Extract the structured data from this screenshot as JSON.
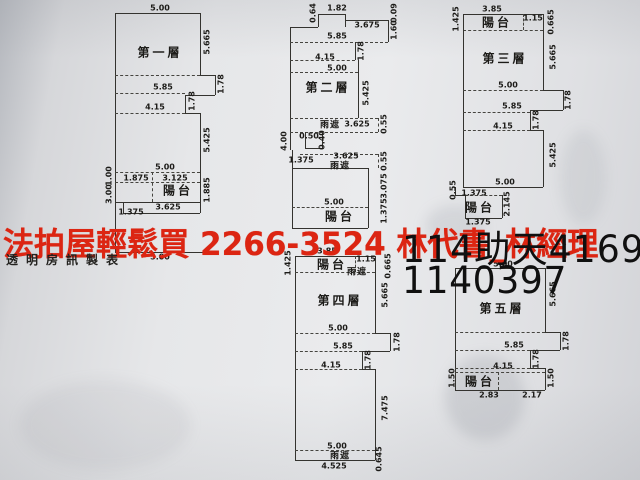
{
  "colors": {
    "red": "#dc2512",
    "ink": "#34332f",
    "paper": "#e7e8ea"
  },
  "overlay": {
    "red_text": "法拍屋輕鬆買  2266-3524  林代書_林經理",
    "maker_text": "透明房訊製表",
    "case_line1": "114助天4169",
    "case_line2": "1140397"
  },
  "floorplans": [
    {
      "id": "floor-1",
      "title": {
        "t": "第一層",
        "x": 160,
        "y": 52
      },
      "labels": [
        {
          "t": "5.00",
          "x": 160,
          "y": 8
        },
        {
          "t": "5.665",
          "x": 207,
          "y": 42,
          "r": 1
        },
        {
          "t": "1.78",
          "x": 221,
          "y": 84,
          "r": 1
        },
        {
          "t": "5.85",
          "x": 163,
          "y": 87
        },
        {
          "t": "1.78",
          "x": 192,
          "y": 101,
          "r": 1
        },
        {
          "t": "4.15",
          "x": 155,
          "y": 107
        },
        {
          "t": "5.425",
          "x": 207,
          "y": 140,
          "r": 1
        },
        {
          "t": "5.00",
          "x": 165,
          "y": 167
        },
        {
          "t": "1.00",
          "x": 109,
          "y": 176,
          "r": 1
        },
        {
          "t": "1.875",
          "x": 136,
          "y": 178
        },
        {
          "t": "3.125",
          "x": 175,
          "y": 178
        },
        {
          "t": "陽台",
          "x": 178,
          "y": 190,
          "k": "room"
        },
        {
          "t": "3.00",
          "x": 109,
          "y": 194,
          "r": 1
        },
        {
          "t": "1.885",
          "x": 207,
          "y": 190,
          "r": 1
        },
        {
          "t": "3.625",
          "x": 168,
          "y": 207
        },
        {
          "t": "1.375",
          "x": 131,
          "y": 212
        },
        {
          "t": "5.00",
          "x": 160,
          "y": 257
        }
      ]
    },
    {
      "id": "floor-2",
      "title": {
        "t": "第二層",
        "x": 328,
        "y": 87
      },
      "labels": [
        {
          "t": "0.64",
          "x": 313,
          "y": 13,
          "r": 1
        },
        {
          "t": "1.82",
          "x": 337,
          "y": 8
        },
        {
          "t": "3.675",
          "x": 367,
          "y": 25
        },
        {
          "t": "0.09",
          "x": 394,
          "y": 13,
          "r": 1
        },
        {
          "t": "1.60",
          "x": 394,
          "y": 30,
          "r": 1
        },
        {
          "t": "5.85",
          "x": 337,
          "y": 36
        },
        {
          "t": "1.78",
          "x": 361,
          "y": 51,
          "r": 1
        },
        {
          "t": "4.15",
          "x": 325,
          "y": 57
        },
        {
          "t": "5.00",
          "x": 337,
          "y": 68
        },
        {
          "t": "5.425",
          "x": 366,
          "y": 93,
          "r": 1
        },
        {
          "t": "雨遮",
          "x": 330,
          "y": 124,
          "k": "small"
        },
        {
          "t": "3.625",
          "x": 357,
          "y": 124
        },
        {
          "t": "0.55",
          "x": 384,
          "y": 124,
          "r": 1
        },
        {
          "t": "0.50",
          "x": 309,
          "y": 136
        },
        {
          "t": "0.40",
          "x": 322,
          "y": 140,
          "r": 1
        },
        {
          "t": "4.00",
          "x": 284,
          "y": 141,
          "r": 1
        },
        {
          "t": "1.375",
          "x": 301,
          "y": 160
        },
        {
          "t": "3.625",
          "x": 346,
          "y": 156
        },
        {
          "t": "雨遮",
          "x": 340,
          "y": 165,
          "k": "small"
        },
        {
          "t": "0.55",
          "x": 384,
          "y": 161,
          "r": 1
        },
        {
          "t": "3.075",
          "x": 384,
          "y": 186,
          "r": 1
        },
        {
          "t": "5.00",
          "x": 334,
          "y": 202
        },
        {
          "t": "陽台",
          "x": 340,
          "y": 216,
          "k": "room"
        },
        {
          "t": "1.375",
          "x": 384,
          "y": 211,
          "r": 1
        }
      ]
    },
    {
      "id": "floor-3",
      "title": {
        "t": "第三層",
        "x": 505,
        "y": 58
      },
      "labels": [
        {
          "t": "3.85",
          "x": 492,
          "y": 9
        },
        {
          "t": "1.425",
          "x": 456,
          "y": 19,
          "r": 1
        },
        {
          "t": "陽台",
          "x": 497,
          "y": 22,
          "k": "room"
        },
        {
          "t": "1.15",
          "x": 533,
          "y": 18
        },
        {
          "t": "0.665",
          "x": 551,
          "y": 22,
          "r": 1
        },
        {
          "t": "5.665",
          "x": 553,
          "y": 57,
          "r": 1
        },
        {
          "t": "5.00",
          "x": 508,
          "y": 85
        },
        {
          "t": "1.78",
          "x": 568,
          "y": 100,
          "r": 1
        },
        {
          "t": "5.85",
          "x": 512,
          "y": 106
        },
        {
          "t": "1.78",
          "x": 536,
          "y": 120,
          "r": 1
        },
        {
          "t": "4.15",
          "x": 503,
          "y": 126
        },
        {
          "t": "5.425",
          "x": 553,
          "y": 155,
          "r": 1
        },
        {
          "t": "5.00",
          "x": 505,
          "y": 182
        },
        {
          "t": "0.55",
          "x": 453,
          "y": 190,
          "r": 1
        },
        {
          "t": "1.375",
          "x": 474,
          "y": 193
        },
        {
          "t": "陽台",
          "x": 480,
          "y": 207,
          "k": "room"
        },
        {
          "t": "2.145",
          "x": 507,
          "y": 204,
          "r": 1
        },
        {
          "t": "1.375",
          "x": 478,
          "y": 222
        }
      ]
    },
    {
      "id": "floor-4",
      "title": {
        "t": "第四層",
        "x": 340,
        "y": 300
      },
      "labels": [
        {
          "t": "3.85",
          "x": 327,
          "y": 251
        },
        {
          "t": "1.425",
          "x": 288,
          "y": 263,
          "r": 1
        },
        {
          "t": "陽台",
          "x": 332,
          "y": 264,
          "k": "room"
        },
        {
          "t": "1.15",
          "x": 366,
          "y": 259
        },
        {
          "t": "雨遮",
          "x": 357,
          "y": 271,
          "k": "small"
        },
        {
          "t": "0.665",
          "x": 388,
          "y": 266,
          "r": 1
        },
        {
          "t": "5.665",
          "x": 385,
          "y": 295,
          "r": 1
        },
        {
          "t": "5.00",
          "x": 338,
          "y": 328
        },
        {
          "t": "1.78",
          "x": 397,
          "y": 342,
          "r": 1
        },
        {
          "t": "5.85",
          "x": 343,
          "y": 346
        },
        {
          "t": "1.78",
          "x": 368,
          "y": 360,
          "r": 1
        },
        {
          "t": "4.15",
          "x": 331,
          "y": 365
        },
        {
          "t": "7.475",
          "x": 385,
          "y": 408,
          "r": 1
        },
        {
          "t": "5.00",
          "x": 337,
          "y": 446
        },
        {
          "t": "雨遮",
          "x": 340,
          "y": 455,
          "k": "small"
        },
        {
          "t": "4.525",
          "x": 334,
          "y": 466
        },
        {
          "t": "0.645",
          "x": 379,
          "y": 459,
          "r": 1
        }
      ]
    },
    {
      "id": "floor-5",
      "title": {
        "t": "第五層",
        "x": 502,
        "y": 308
      },
      "labels": [
        {
          "t": "5.00",
          "x": 503,
          "y": 264
        },
        {
          "t": "5.665",
          "x": 553,
          "y": 294,
          "r": 1
        },
        {
          "t": "5.85",
          "x": 514,
          "y": 345
        },
        {
          "t": "1.78",
          "x": 566,
          "y": 341,
          "r": 1
        },
        {
          "t": "1.78",
          "x": 536,
          "y": 359,
          "r": 1
        },
        {
          "t": "4.15",
          "x": 503,
          "y": 366
        },
        {
          "t": "1.50",
          "x": 452,
          "y": 378,
          "r": 1
        },
        {
          "t": "陽台",
          "x": 480,
          "y": 381,
          "k": "room"
        },
        {
          "t": "1.50",
          "x": 551,
          "y": 378,
          "r": 1
        },
        {
          "t": "2.83",
          "x": 489,
          "y": 395
        },
        {
          "t": "2.17",
          "x": 532,
          "y": 395
        }
      ]
    }
  ]
}
